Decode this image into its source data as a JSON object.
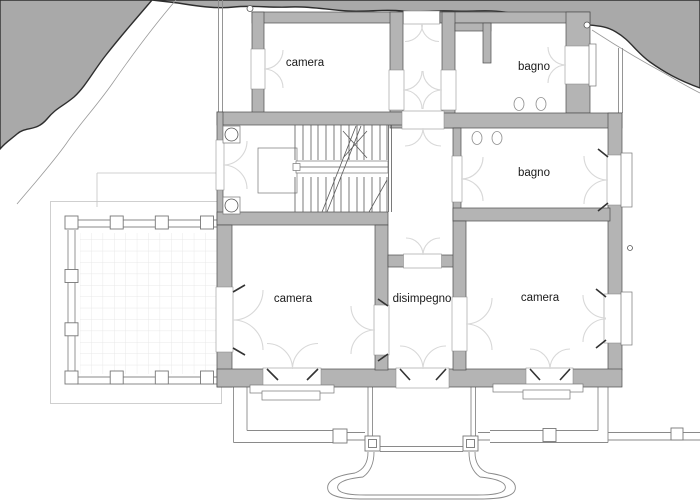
{
  "plan": {
    "title": "floor-plan",
    "rooms": [
      {
        "id": "camera-nw",
        "label": "camera",
        "cx": 305,
        "cy": 62
      },
      {
        "id": "bagno-ne",
        "label": "bagno",
        "cx": 534,
        "cy": 66
      },
      {
        "id": "bagno-e",
        "label": "bagno",
        "cx": 534,
        "cy": 172
      },
      {
        "id": "camera-sw",
        "label": "camera",
        "cx": 293,
        "cy": 298
      },
      {
        "id": "disimpegno",
        "label": "disimpegno",
        "cx": 422,
        "cy": 298
      },
      {
        "id": "camera-se",
        "label": "camera",
        "cx": 540,
        "cy": 297
      }
    ],
    "symbols": {
      "bath_fixtures": [
        "washbasin",
        "washbasin",
        "wc",
        "bidet"
      ],
      "stair": "dog-leg-staircase",
      "columns": 2,
      "entrance": "horseshoe-stair"
    },
    "colors": {
      "wall_fill": "#b4b4b4",
      "wall_edge": "#4d4d4d",
      "hill_fill": "#a9a9a9",
      "hill_edge": "#2e2e2e",
      "swing_arc": "#d8d8d8",
      "grid": "#e2e2e2",
      "label_text": "#1a1a1a",
      "background": "#ffffff"
    }
  }
}
